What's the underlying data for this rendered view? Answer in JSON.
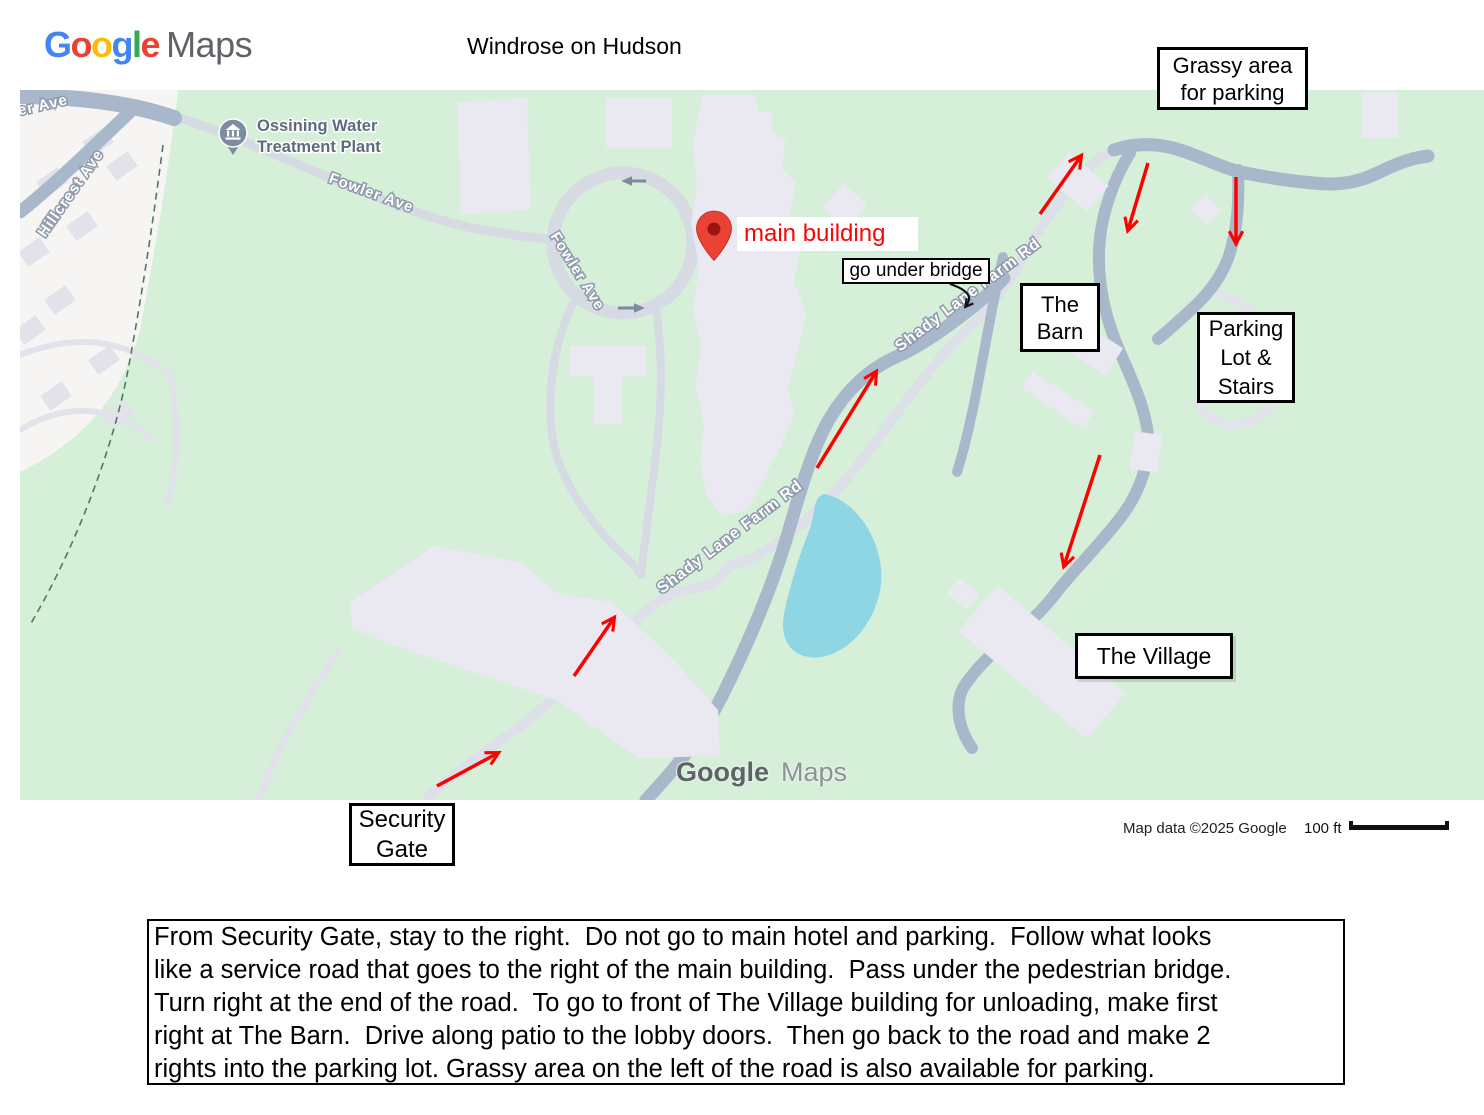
{
  "header": {
    "logo": {
      "letters": [
        {
          "ch": "G",
          "color": "#4285F4"
        },
        {
          "ch": "o",
          "color": "#EA4335"
        },
        {
          "ch": "o",
          "color": "#FBBC05"
        },
        {
          "ch": "g",
          "color": "#4285F4"
        },
        {
          "ch": "l",
          "color": "#34A853"
        },
        {
          "ch": "e",
          "color": "#EA4335"
        }
      ],
      "maps": "Maps"
    },
    "title": "Windrose on Hudson"
  },
  "map": {
    "poi": {
      "line1": "Ossining Water",
      "line2": "Treatment Plant"
    },
    "roads": {
      "fowler": "Fowler Ave",
      "hillcrest": "Hillcrest Ave",
      "shady": "Shady Lane Farm Rd"
    },
    "watermark": {
      "google": "Google",
      "maps": "Maps"
    },
    "pin_label": "main building",
    "annotations": {
      "grassy": "Grassy area\nfor parking",
      "bridge": "go under bridge",
      "barn": "The\nBarn",
      "parking": "Parking\nLot &\nStairs",
      "village": "The Village",
      "security": "Security\nGate"
    },
    "colors": {
      "arrow_red": "#ff0000",
      "map_green": "#d5efd9",
      "road_dark": "#a9b7cb",
      "road_light": "#d8dbe4",
      "water": "#8fd6e4",
      "pin_red": "#EA4335"
    }
  },
  "footer": {
    "attribution": "Map data ©2025 Google",
    "scale_label": "100 ft"
  },
  "directions": "From Security Gate, stay to the right.  Do not go to main hotel and parking.  Follow what looks\nlike a service road that goes to the right of the main building.  Pass under the pedestrian bridge.\nTurn right at the end of the road.  To go to front of The Village building for unloading, make first\nright at The Barn.  Drive along patio to the lobby doors.  Then go back to the road and make 2\nrights into the parking lot. Grassy area on the left of the road is also available for parking."
}
